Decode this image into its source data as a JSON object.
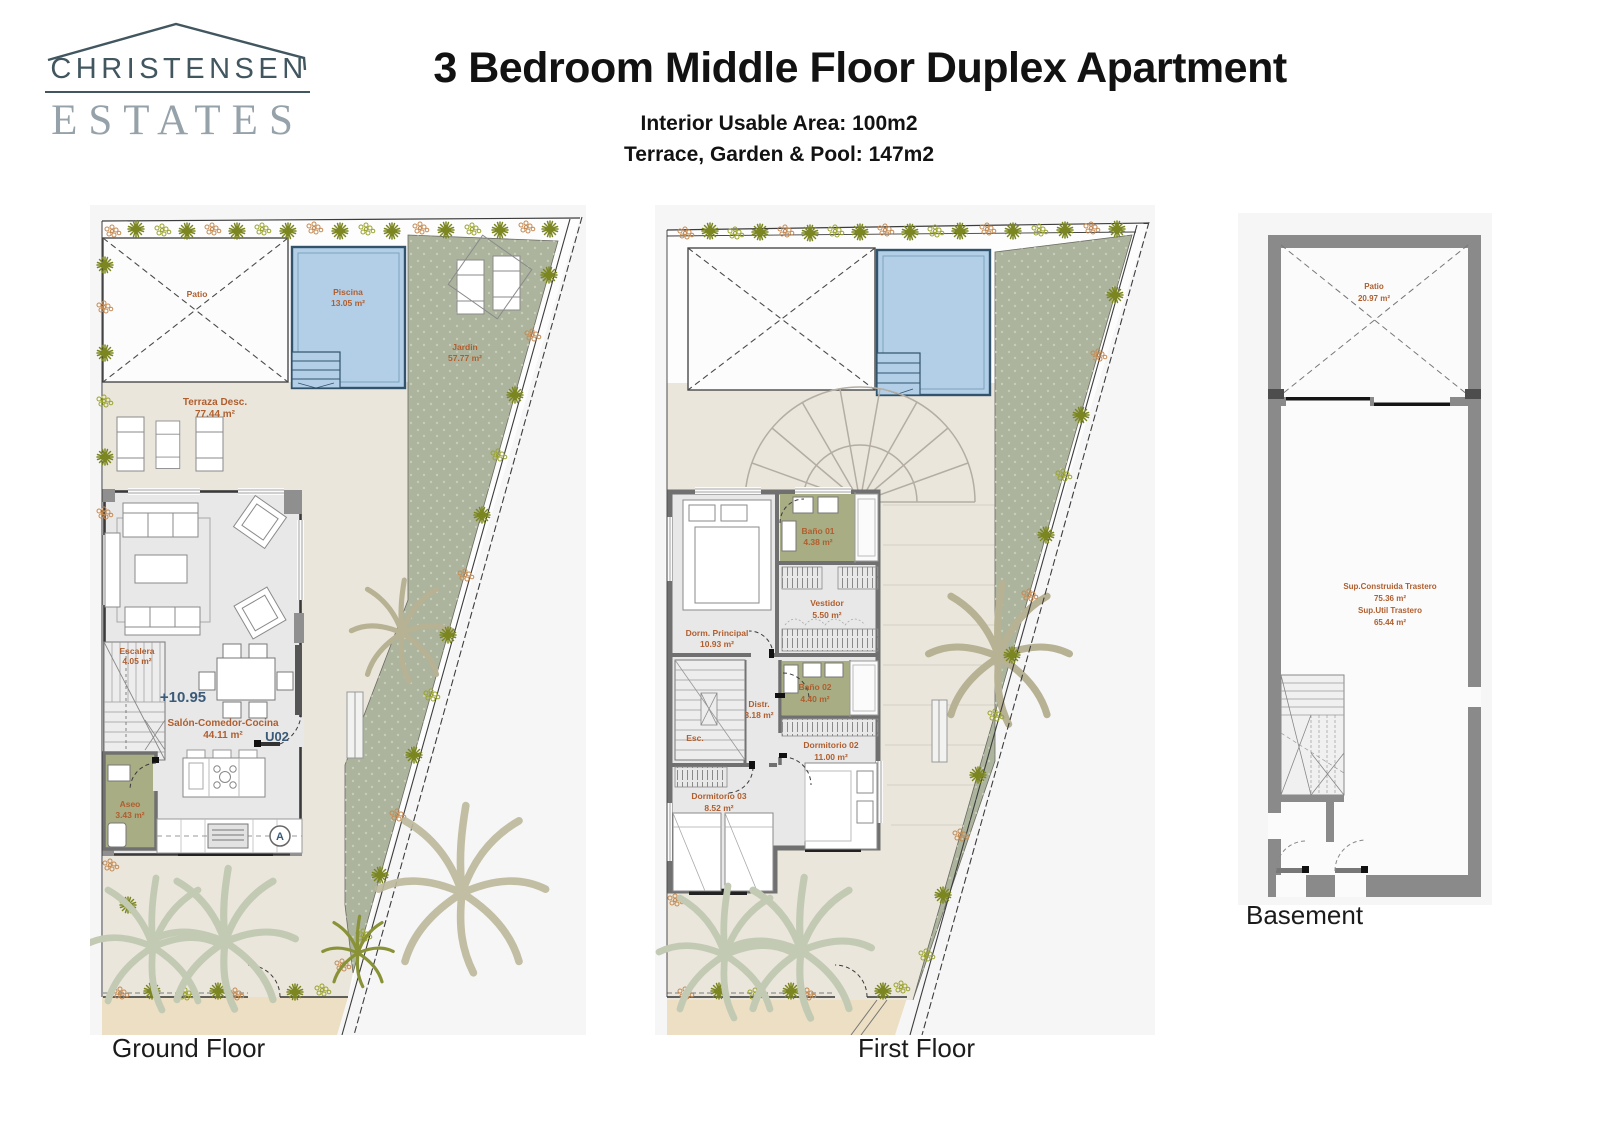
{
  "header": {
    "logo_line1": "CHRISTENSEN",
    "logo_line2": "ESTATES",
    "title": "3 Bedroom Middle Floor Duplex Apartment",
    "subtitle_interior": "Interior Usable Area: 100m2",
    "subtitle_exterior": "Terrace, Garden & Pool: 147m2"
  },
  "plans": {
    "ground": {
      "caption": "Ground Floor",
      "labels": {
        "patio": "Patio",
        "piscina": "Piscina",
        "piscina_area": "13.05 m²",
        "jardin": "Jardin",
        "jardin_area": "57.77 m²",
        "terraza": "Terraza Desc.",
        "terraza_area": "77.44 m²",
        "escalera": "Escalera",
        "escalera_area": "4.05 m²",
        "level": "+10.95",
        "salon": "Salón-Comedor-Cocina",
        "salon_area": "44.11 m²",
        "unit": "U02",
        "aseo": "Aseo",
        "aseo_area": "3.43 m²",
        "section": "A"
      }
    },
    "first": {
      "caption": "First Floor",
      "labels": {
        "dorm_ppal": "Dorm. Principal",
        "dorm_ppal_area": "10.93 m²",
        "bano1": "Baño 01",
        "bano1_area": "4.38 m²",
        "vestidor": "Vestidor",
        "vestidor_area": "5.50 m²",
        "bano2": "Baño 02",
        "bano2_area": "4.40 m²",
        "distr": "Distr.",
        "distr_area": "3.18 m²",
        "esc": "Esc.",
        "dorm2": "Dormitorio 02",
        "dorm2_area": "11.00 m²",
        "dorm3": "Dormitorio 03",
        "dorm3_area": "8.52 m²"
      }
    },
    "basement": {
      "caption": "Basement",
      "labels": {
        "patio": "Patio",
        "patio_area": "20.97 m²",
        "sup_line1": "Sup.Construida Trastero",
        "sup_line2": "75.36 m²",
        "sup_line3": "Sup.Util Trastero",
        "sup_line4": "65.44 m²"
      }
    }
  },
  "colors": {
    "pool": "#b3cfe8",
    "pool_border": "#31536b",
    "garden": "#acb49d",
    "terrace": "#eae6dc",
    "wall_gray": "#707070",
    "wet_room_green": "#a8ad84",
    "label_orange": "#b05e2e",
    "label_blue": "#3a5a78",
    "path_beige": "#ecdfc4",
    "logo_dark": "#41565f",
    "logo_light": "#96a2a9"
  }
}
